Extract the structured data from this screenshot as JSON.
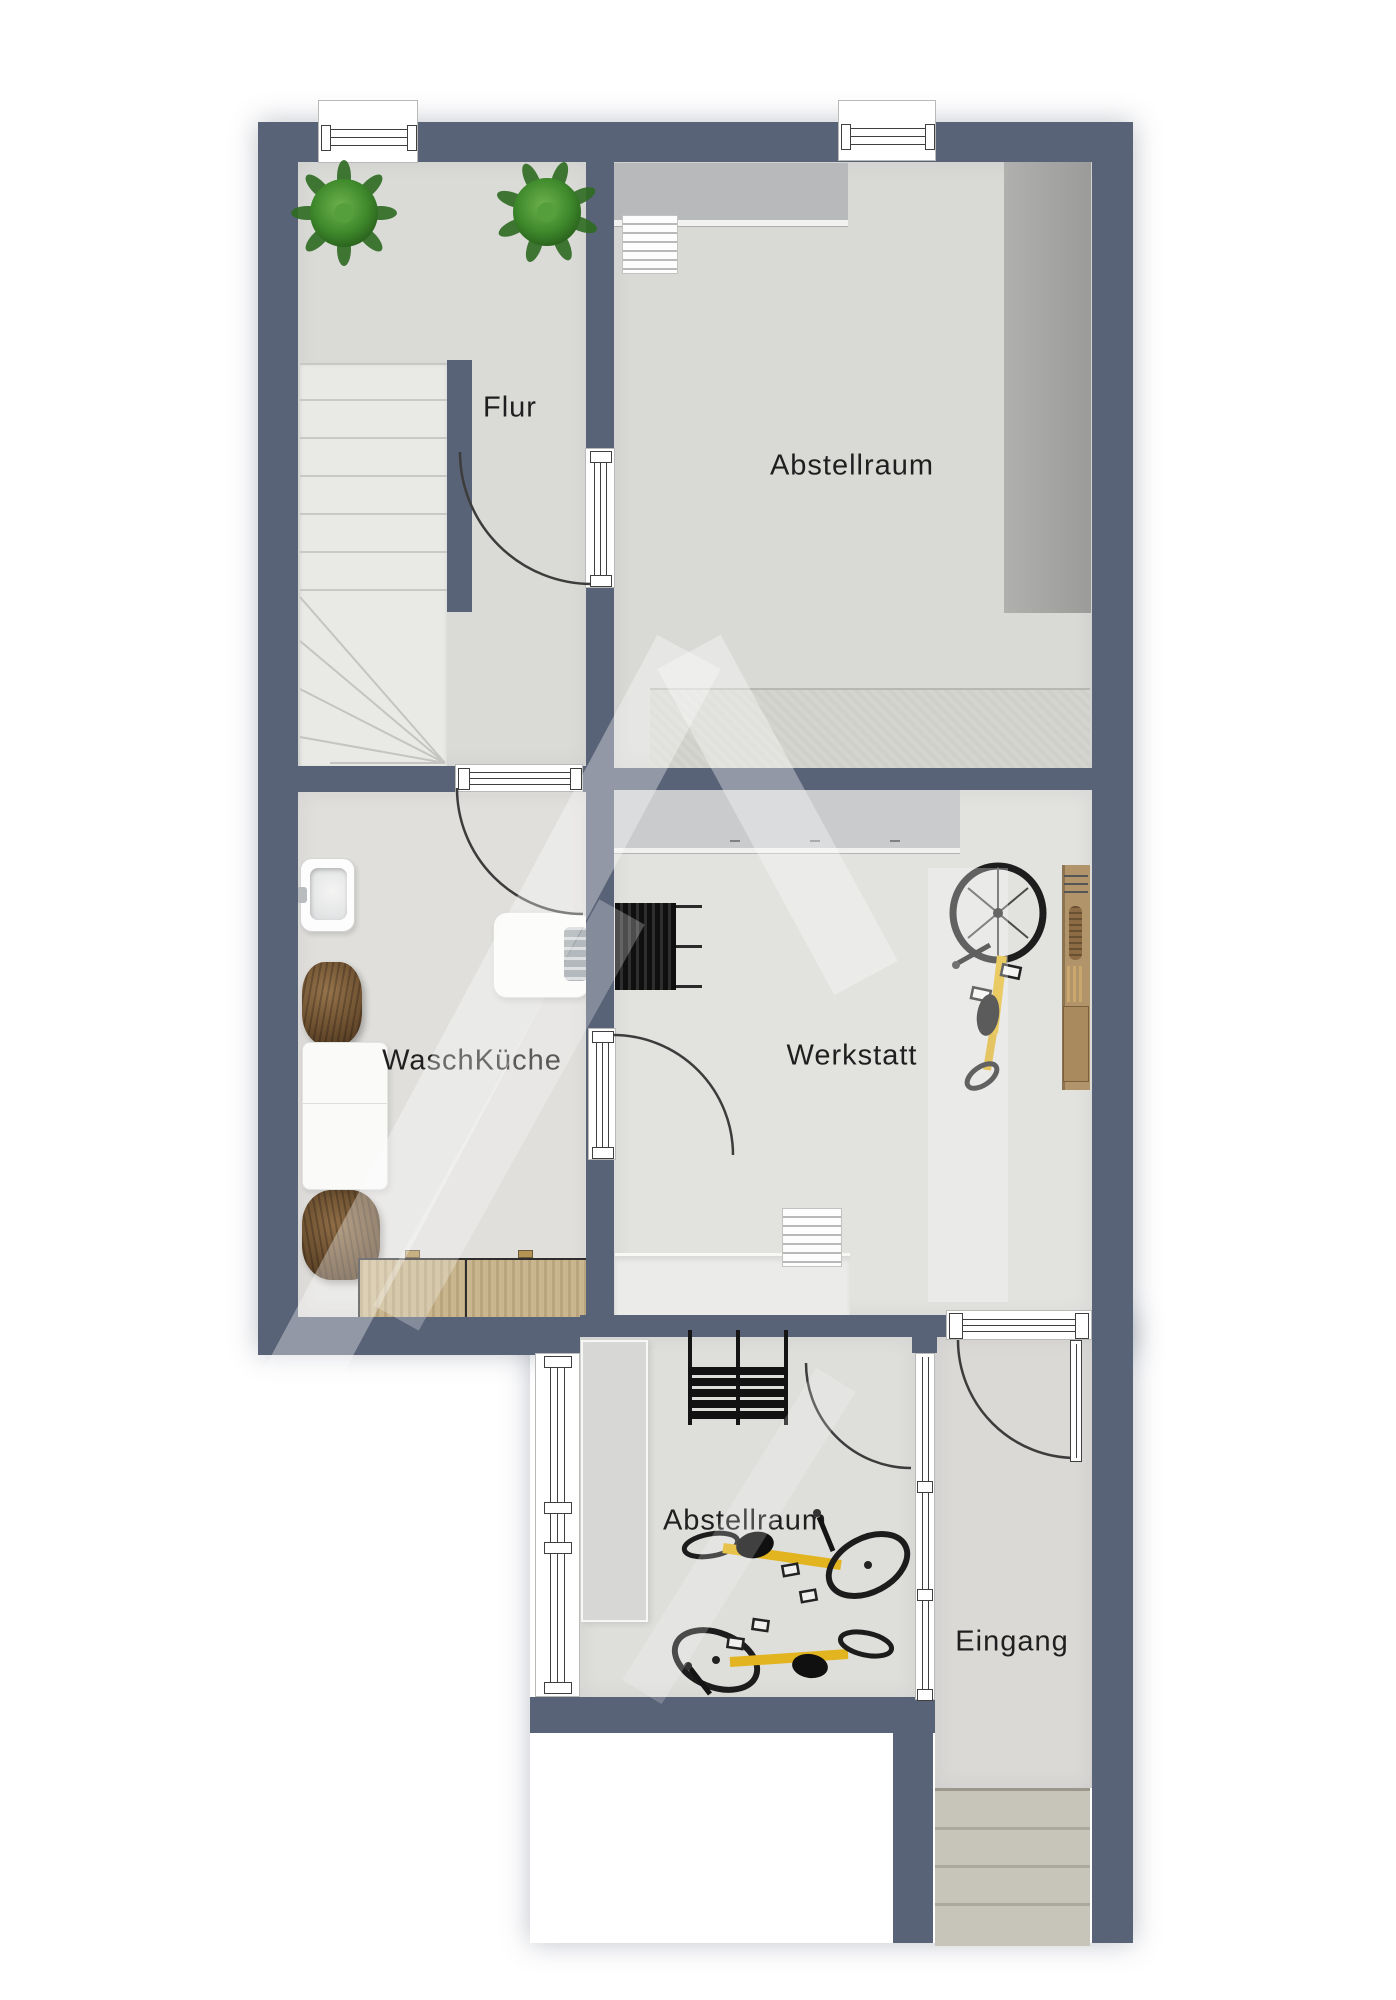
{
  "rooms": {
    "flur": {
      "label": "Flur"
    },
    "abstellraum_top": {
      "label": "Abstellraum"
    },
    "waschkueche": {
      "label": "WaschKüche"
    },
    "werkstatt": {
      "label": "Werkstatt"
    },
    "abstellraum_bottom": {
      "label": "Abstellraum"
    },
    "eingang": {
      "label": "Eingang"
    }
  },
  "colors": {
    "wall": "#596377",
    "floor_light": "#dedddb",
    "bike_accent": "#e2b41f",
    "wood": "#c9b68e",
    "plant_green": "#2e6b22",
    "stair_black": "#141414",
    "outdoor_steps": "#c7c4ba"
  },
  "furniture_icons": [
    "plant-icon",
    "staircase-icon",
    "cabinet-icon",
    "stepladder-icon",
    "storage-rack-icon",
    "mat-icon",
    "sink-icon",
    "washing-machine-icon",
    "wicker-chair-icon",
    "table-icon",
    "sideboard-icon",
    "workbench-icon",
    "weight-rack-icon",
    "bicycle-icon",
    "pegboard-icon",
    "steep-stairs-icon",
    "shelf-icon",
    "outdoor-steps-icon"
  ]
}
